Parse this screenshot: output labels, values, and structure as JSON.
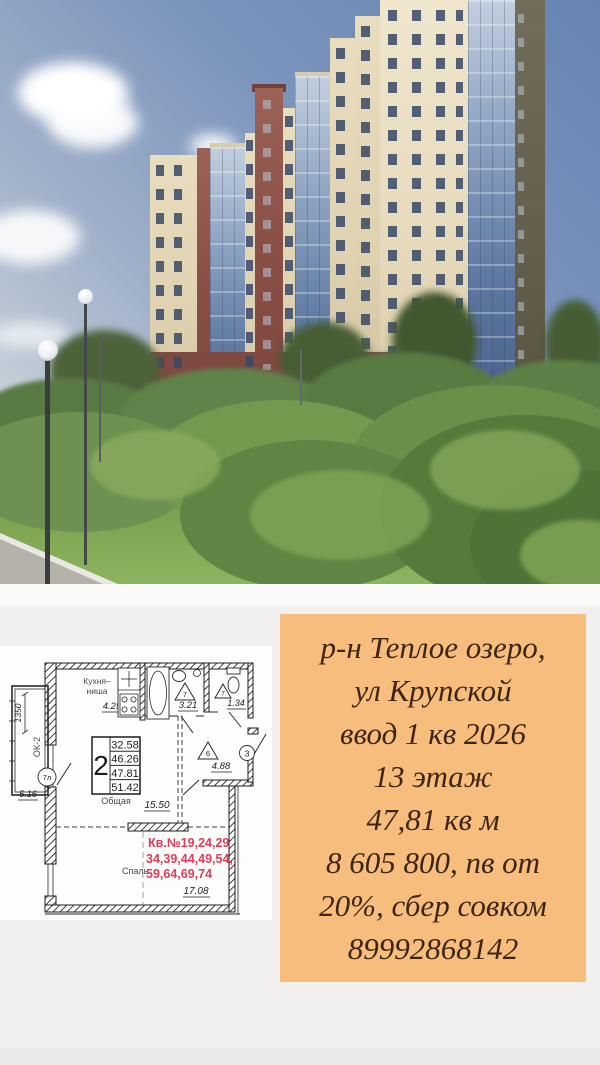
{
  "listing_card": {
    "bg_color": "#f7bd7c",
    "text_color": "#3d2517",
    "lines": [
      "р-н Теплое озеро,",
      "ул Крупской",
      "ввод 1 кв 2026",
      "13 этаж",
      "47,81 кв м",
      "8 605 800, пв от",
      "20%, сбер совком",
      "89992868142"
    ]
  },
  "floor_plan": {
    "accent_color": "#e23a57",
    "area_table": {
      "room_count": "2",
      "values": [
        "32.58",
        "46.26",
        "47.81",
        "51.42"
      ],
      "caption": "Общая"
    },
    "labels": {
      "kitchen_line1": "Кухня–",
      "kitchen_line2": "ниша",
      "kitchen_area": "4.25",
      "bath_area": "3.21",
      "wc_area": "1.34",
      "hall_area": "4.88",
      "living_area": "15.50",
      "bedroom_label": "Спаль",
      "bedroom_area": "17.08",
      "balcony_window": "ОК-2",
      "balcony_dim": "1350",
      "balcony_area": "5.16",
      "balcony_marker": "7л",
      "bath_marker": "7",
      "wc_marker": "7",
      "hall_marker": "6",
      "entry_marker": "3"
    },
    "apartment_numbers": [
      "Кв.№19,24,29",
      "34,39,44,49,54,",
      "59,64,69,74"
    ]
  }
}
